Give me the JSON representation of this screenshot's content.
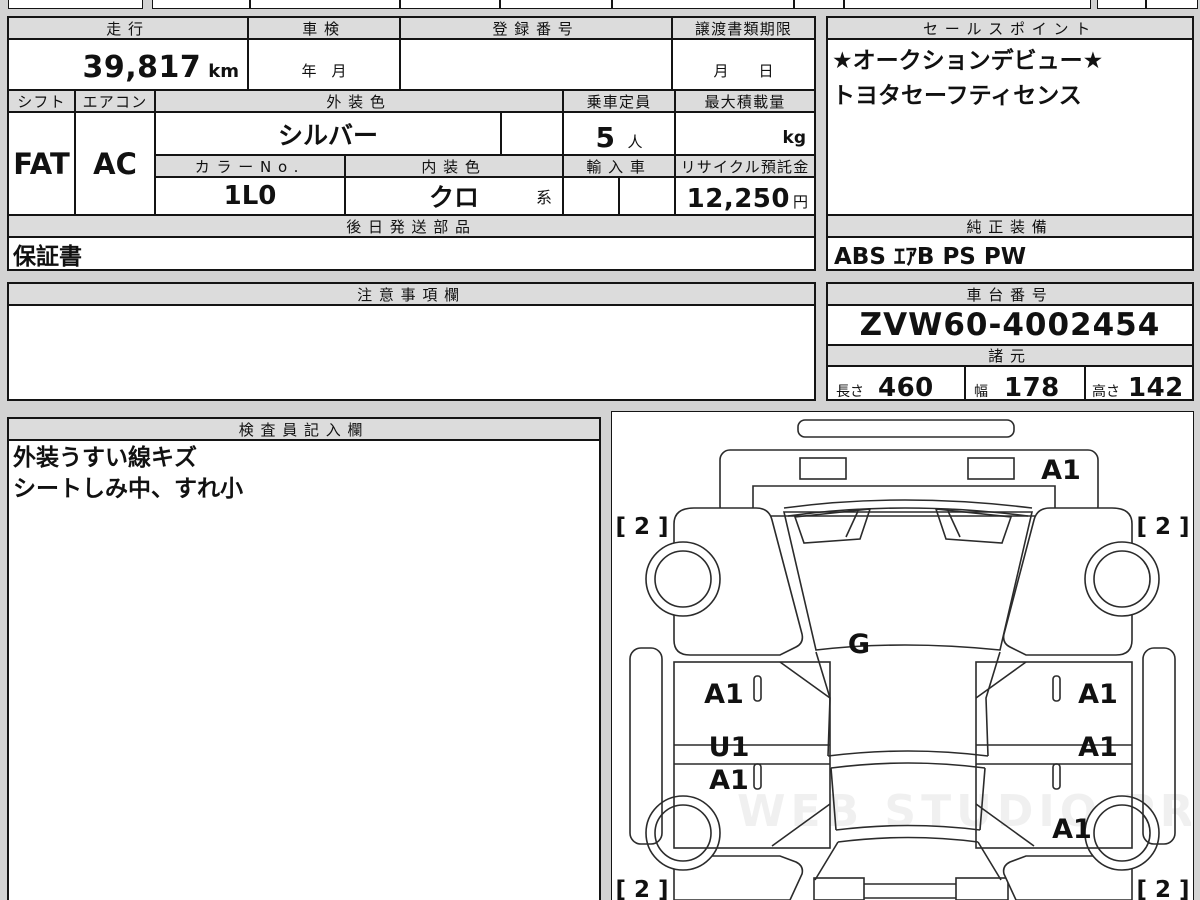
{
  "colors": {
    "page_bg": "#d3d3d3",
    "header_fill": "#dcdcdc",
    "cell_fill": "#ffffff",
    "line": "#141414"
  },
  "left_table": {
    "mileage_label": "走行",
    "mileage_value": "39,817",
    "mileage_unit": "km",
    "inspection_label": "車検",
    "inspection_placeholder": "年　月",
    "registration_label": "登録番号",
    "deadline_label": "譲渡書類期限",
    "deadline_placeholder": "月　　日",
    "shift_label": "シフト",
    "shift_value": "FAT",
    "aircon_label": "エアコン",
    "aircon_value": "AC",
    "exterior_color_label": "外装色",
    "exterior_color_value": "シルバー",
    "capacity_label": "乗車定員",
    "capacity_value": "5",
    "capacity_unit": "人",
    "max_load_label": "最大積載量",
    "max_load_unit": "kg",
    "color_no_label": "カラーNo.",
    "color_no_value": "1L0",
    "interior_color_label": "内装色",
    "interior_color_value": "クロ",
    "interior_color_suffix": "系",
    "import_label": "輸入車",
    "recycle_label": "リサイクル預託金",
    "recycle_value": "12,250",
    "recycle_unit": "円",
    "later_parts_label": "後日発送部品",
    "later_parts_value": "保証書"
  },
  "sales_point": {
    "label": "セールスポイント",
    "line1": "★オークションデビュー★",
    "line2": "トヨタセーフティセンス"
  },
  "equipment": {
    "label": "純正装備",
    "value": "ABS ｴｱB PS PW"
  },
  "notes": {
    "label": "注意事項欄"
  },
  "chassis": {
    "label": "車台番号",
    "value": "ZVW60-4002454"
  },
  "specs": {
    "label": "諸元",
    "length_label": "長さ",
    "length_value": "460",
    "width_label": "幅",
    "width_value": "178",
    "height_label": "高さ",
    "height_value": "142"
  },
  "inspector": {
    "label": "検査員記入欄",
    "line1": "外装うすい線キズ",
    "line2": "シートしみ中、すれ小"
  },
  "diagram": {
    "watermark": "WEB STUDIO PRO",
    "hood_mark": "A1",
    "glass_mark": "G",
    "tire_front_left": "[ 2 ]",
    "tire_front_right": "[ 2 ]",
    "tire_rear_left": "[ 2 ]",
    "tire_rear_right": "[ 2 ]",
    "door_front_left_mark": "A1",
    "door_rear_left_mark_upper": "U1",
    "door_rear_left_mark_lower": "A1",
    "door_front_right_mark": "A1",
    "door_rear_right_mark": "A1",
    "quarter_rear_right_mark": "A1"
  }
}
